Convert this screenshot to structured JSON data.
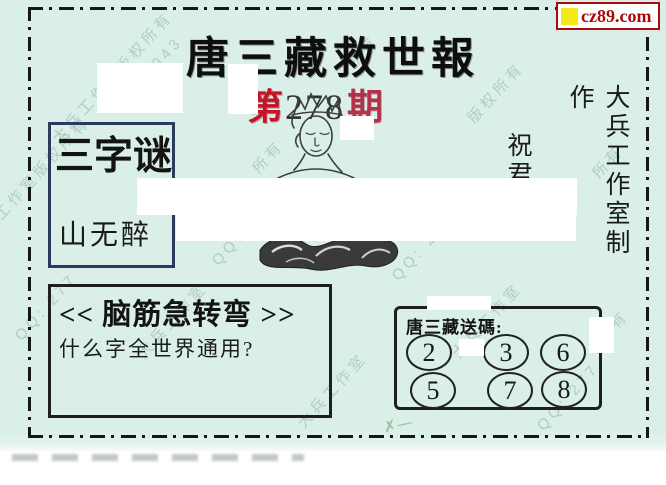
{
  "site_badge": {
    "text": "cz89.com"
  },
  "masthead": {
    "title": "唐三藏救世報",
    "issue_prefix": "第",
    "issue_number": "278",
    "issue_suffix": "期"
  },
  "publisher": {
    "vertical_credit": "大兵工作室制作",
    "blessing": "祝君"
  },
  "riddle_box": {
    "title": "三字谜",
    "content": "山无醉"
  },
  "brain_teaser": {
    "header": "<< 脑筋急转弯 >>",
    "question": "什么字全世界通用?"
  },
  "lucky_codes": {
    "label": "唐三藏送碼:",
    "numbers": [
      "2",
      "3",
      "6",
      "5",
      "7",
      "8"
    ]
  },
  "watermark": {
    "items": [
      "大兵工作室版权所有",
      "QQ: 277",
      "943",
      "大兵工作室",
      "所有",
      "版权所有"
    ]
  },
  "colors": {
    "paper": "#d9efe8",
    "badge_red": "#a80b0b",
    "badge_yellow": "#f6e91a",
    "issue_prefix_red": "#c41426",
    "issue_suffix_red": "#b5304a",
    "riddle_border_navy": "#2c3a5e"
  }
}
